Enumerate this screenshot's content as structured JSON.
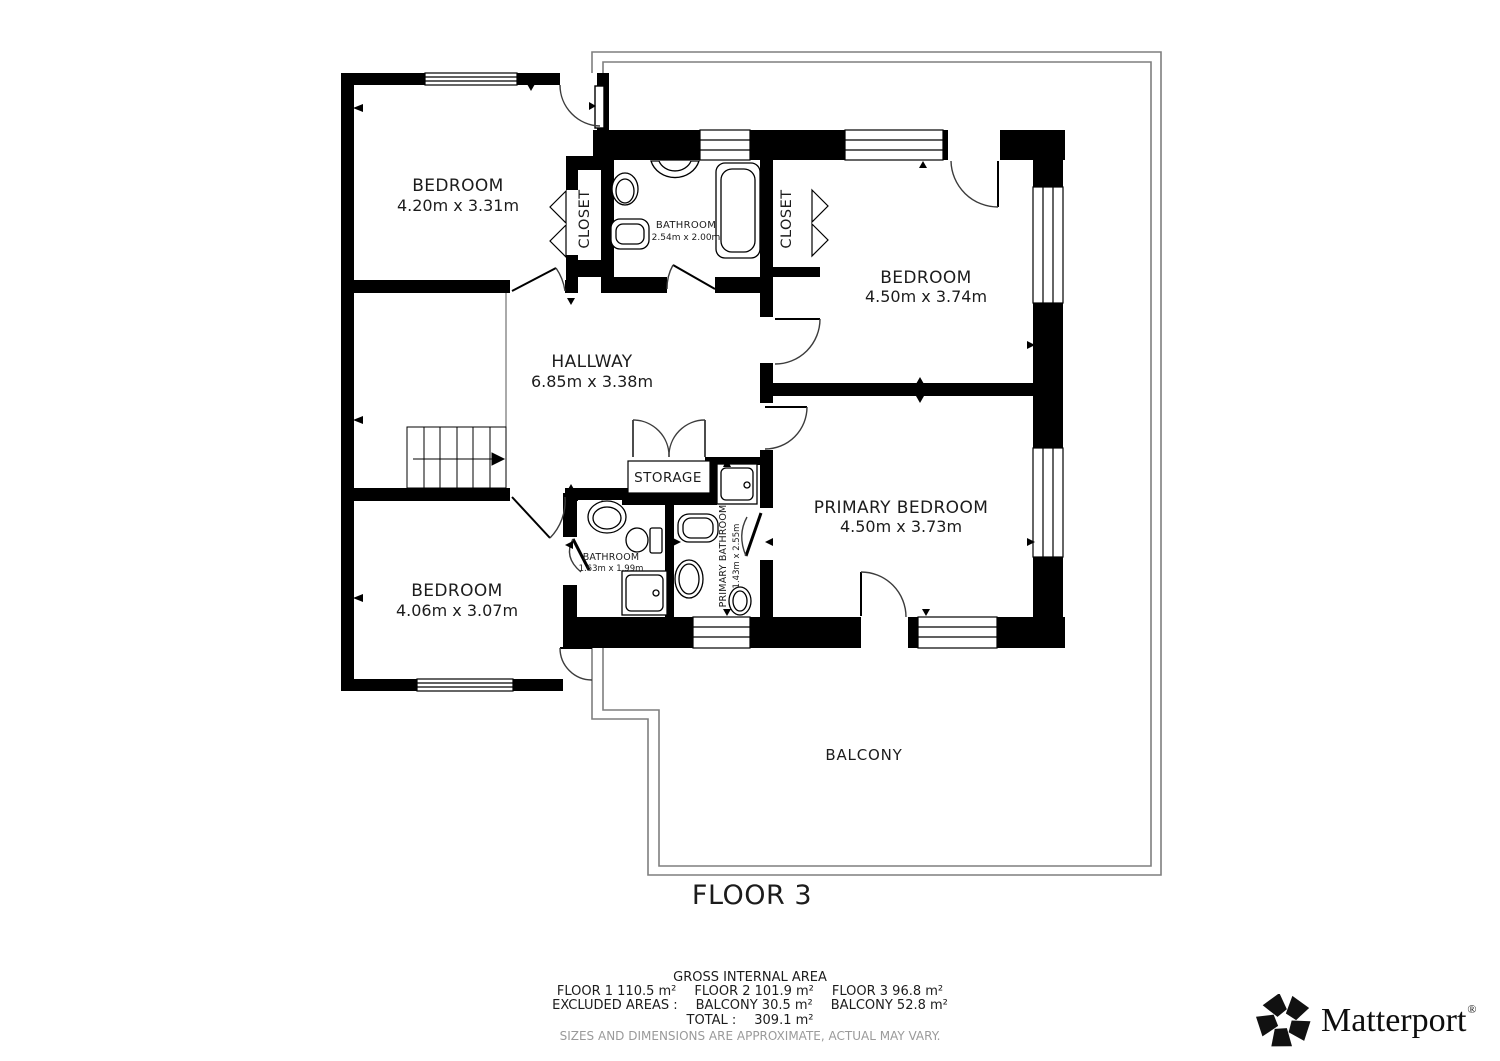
{
  "rooms": {
    "bedroom1": {
      "name": "BEDROOM",
      "dims": "4.20m x 3.31m"
    },
    "bedroom2": {
      "name": "BEDROOM",
      "dims": "4.50m x 3.74m"
    },
    "bedroom3": {
      "name": "BEDROOM",
      "dims": "4.06m x 3.07m"
    },
    "primary_bedroom": {
      "name": "PRIMARY BEDROOM",
      "dims": "4.50m x 3.73m"
    },
    "hallway": {
      "name": "HALLWAY",
      "dims": "6.85m x 3.38m"
    },
    "bathroom1": {
      "name": "BATHROOM",
      "dims": "2.54m x 2.00m"
    },
    "bathroom2": {
      "name": "BATHROOM",
      "dims": "1.63m x 1.99m"
    },
    "primary_bathroom": {
      "name": "PRIMARY BATHROOM",
      "dims": "1.43m x 2.55m"
    },
    "closet1": {
      "name": "CLOSET"
    },
    "closet2": {
      "name": "CLOSET"
    },
    "storage": {
      "name": "STORAGE"
    },
    "balcony": {
      "name": "BALCONY"
    }
  },
  "floor": {
    "label": "FLOOR 3"
  },
  "footer": {
    "title": "GROSS INTERNAL AREA",
    "floors": [
      "FLOOR 1 110.5 m²",
      "FLOOR 2 101.9 m²",
      "FLOOR 3 96.8 m²"
    ],
    "excluded_label": "EXCLUDED AREAS :",
    "excluded": [
      "BALCONY 30.5 m²",
      "BALCONY 52.8 m²"
    ],
    "total_label": "TOTAL :",
    "total_value": "309.1 m²",
    "disclaimer": "SIZES AND DIMENSIONS ARE APPROXIMATE, ACTUAL MAY VARY."
  },
  "branding": {
    "name": "Matterport",
    "mark": "®"
  },
  "colors": {
    "wall": "#000000",
    "balcony_line": "#7f7f7f",
    "text": "#1c1c1c",
    "muted": "#9a9a9a"
  }
}
